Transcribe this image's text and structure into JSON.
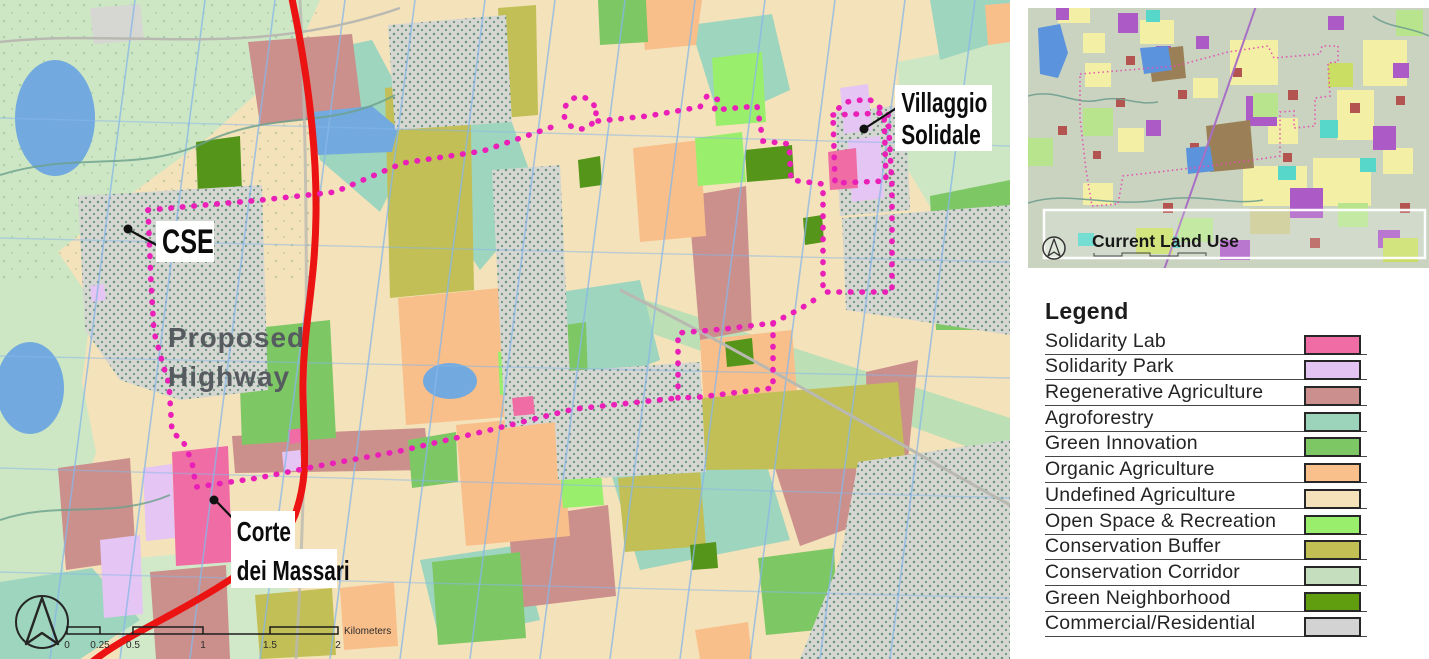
{
  "main_map": {
    "labels": {
      "cse": "CSE",
      "villaggio_line1": "Villaggio",
      "villaggio_line2": "Solidale",
      "corte_line1": "Corte",
      "corte_line2": "dei Massari",
      "proposed_highway_line1": "Proposed",
      "proposed_highway_line2": "Highway"
    },
    "scale_bar": {
      "ticks": [
        "0",
        "0.25",
        "0.5",
        "1",
        "1.5",
        "2"
      ],
      "unit": "Kilometers"
    }
  },
  "inset_map": {
    "title": "Current Land Use"
  },
  "legend": {
    "title": "Legend",
    "items": [
      {
        "label": "Solidarity Lab",
        "color": "#F06CA4"
      },
      {
        "label": "Solidarity Park",
        "color": "#E3C3F2"
      },
      {
        "label": "Regenerative Agriculture",
        "color": "#CB908E"
      },
      {
        "label": "Agroforestry",
        "color": "#9BD3BB"
      },
      {
        "label": "Green Innovation",
        "color": "#7EC765"
      },
      {
        "label": "Organic Agriculture",
        "color": "#F9C08C"
      },
      {
        "label": "Undefined Agriculture",
        "color": "#F5E2BA"
      },
      {
        "label": "Open Space & Recreation",
        "color": "#99EF6C"
      },
      {
        "label": "Conservation Buffer",
        "color": "#C2C055"
      },
      {
        "label": "Conservation Corridor",
        "color": "#C4DEBE"
      },
      {
        "label": "Green Neighborhood",
        "color": "#609E10"
      },
      {
        "label": "Commercial/Residential",
        "color": "#D3D3D3"
      }
    ]
  },
  "map_colors": {
    "highway_red": "#EC1313",
    "boundary_magenta": "#EA1FB8",
    "water_blue": "#72AADF",
    "proposed_highway_text": "#565B60"
  }
}
